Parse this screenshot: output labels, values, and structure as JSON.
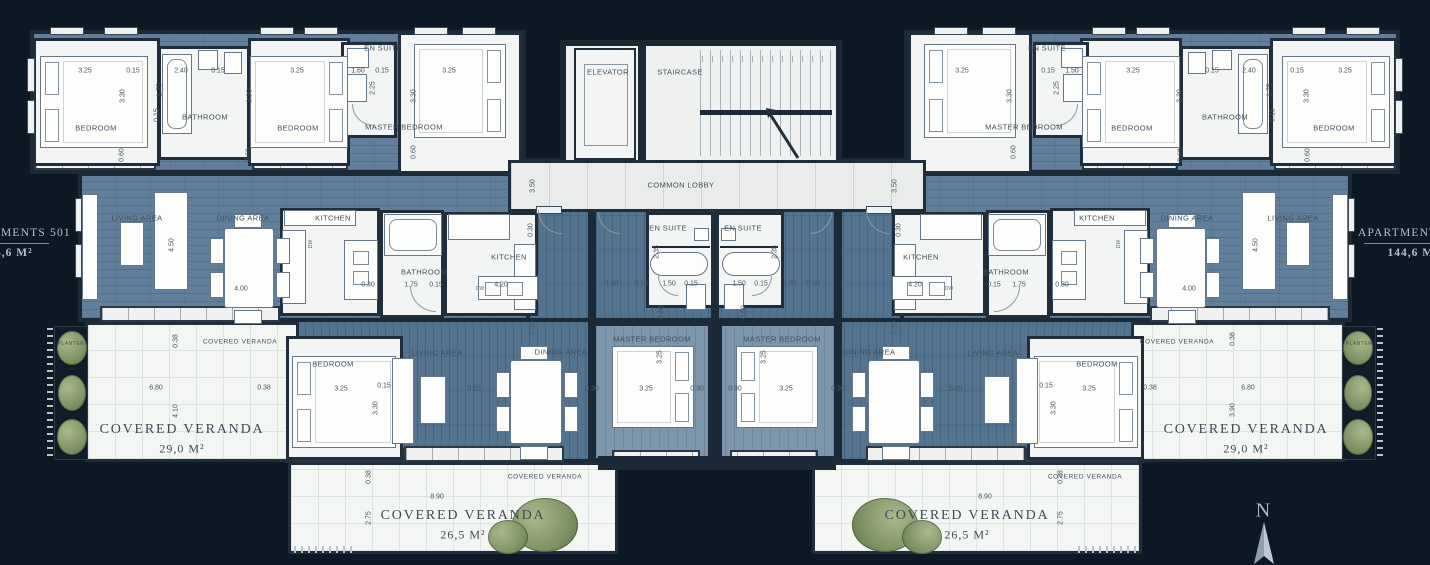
{
  "plan": {
    "background": "#0c1823",
    "floor_blue": "#617f9b",
    "floor_blue_dark": "#53738f",
    "room_white": "#f3f5f4",
    "wall_color": "#1c2a37",
    "label_color": "#3d4b57",
    "edge_text_color": "#b3c1cb",
    "plant_green": "#84966a"
  },
  "side_labels": {
    "left": {
      "name": "APARTMENTS 501",
      "area": "144,6 M²"
    },
    "right": {
      "name": "APARTMENTS 501",
      "area": "144,6 M²"
    }
  },
  "compass": {
    "label": "N"
  },
  "annotations": [
    {
      "t": "3.25",
      "x": 85,
      "y": 71,
      "c": "dim"
    },
    {
      "t": "0.15",
      "x": 133,
      "y": 71,
      "c": "dim"
    },
    {
      "t": "2.40",
      "x": 181,
      "y": 71,
      "c": "dim"
    },
    {
      "t": "0.15",
      "x": 218,
      "y": 71,
      "c": "dim"
    },
    {
      "t": "3.25",
      "x": 297,
      "y": 71,
      "c": "dim"
    },
    {
      "t": "1.60",
      "x": 358,
      "y": 71,
      "c": "dim"
    },
    {
      "t": "0.15",
      "x": 382,
      "y": 71,
      "c": "dim"
    },
    {
      "t": "3.25",
      "x": 449,
      "y": 71,
      "c": "dim"
    },
    {
      "t": "1.75",
      "x": 160,
      "y": 90,
      "c": "dim",
      "r": -90
    },
    {
      "t": "3.30",
      "x": 123,
      "y": 96,
      "c": "dim",
      "r": -90
    },
    {
      "t": "3.30",
      "x": 250,
      "y": 96,
      "c": "dim",
      "r": -90
    },
    {
      "t": "2.25",
      "x": 373,
      "y": 88,
      "c": "dim",
      "r": -90
    },
    {
      "t": "3.30",
      "x": 414,
      "y": 96,
      "c": "dim",
      "r": -90
    },
    {
      "t": "0.15",
      "x": 157,
      "y": 115,
      "c": "dim",
      "r": -90
    },
    {
      "t": "0.60",
      "x": 122,
      "y": 155,
      "c": "dim",
      "r": -90
    },
    {
      "t": "0.60",
      "x": 249,
      "y": 155,
      "c": "dim",
      "r": -90
    },
    {
      "t": "0.60",
      "x": 414,
      "y": 152,
      "c": "dim",
      "r": -90
    },
    {
      "t": "BEDROOM",
      "x": 96,
      "y": 128,
      "c": "room"
    },
    {
      "t": "BATHROOM",
      "x": 205,
      "y": 117,
      "c": "room"
    },
    {
      "t": "BEDROOM",
      "x": 298,
      "y": 128,
      "c": "room"
    },
    {
      "t": "EN SUITE",
      "x": 383,
      "y": 48,
      "c": "room"
    },
    {
      "t": "MASTER BEDROOM",
      "x": 404,
      "y": 127,
      "c": "room"
    },
    {
      "t": "3.25",
      "x": 1345,
      "y": 71,
      "c": "dim"
    },
    {
      "t": "0.15",
      "x": 1297,
      "y": 71,
      "c": "dim"
    },
    {
      "t": "2.40",
      "x": 1249,
      "y": 71,
      "c": "dim"
    },
    {
      "t": "0.15",
      "x": 1212,
      "y": 71,
      "c": "dim"
    },
    {
      "t": "3.25",
      "x": 1133,
      "y": 71,
      "c": "dim"
    },
    {
      "t": "1.50",
      "x": 1072,
      "y": 71,
      "c": "dim"
    },
    {
      "t": "0.15",
      "x": 1048,
      "y": 71,
      "c": "dim"
    },
    {
      "t": "3.25",
      "x": 962,
      "y": 71,
      "c": "dim"
    },
    {
      "t": "1.75",
      "x": 1270,
      "y": 90,
      "c": "dim",
      "r": -90
    },
    {
      "t": "3.30",
      "x": 1307,
      "y": 96,
      "c": "dim",
      "r": -90
    },
    {
      "t": "3.30",
      "x": 1180,
      "y": 96,
      "c": "dim",
      "r": -90
    },
    {
      "t": "2.25",
      "x": 1057,
      "y": 88,
      "c": "dim",
      "r": -90
    },
    {
      "t": "3.30",
      "x": 1010,
      "y": 96,
      "c": "dim",
      "r": -90
    },
    {
      "t": "0.15",
      "x": 1273,
      "y": 115,
      "c": "dim",
      "r": -90
    },
    {
      "t": "0.60",
      "x": 1308,
      "y": 155,
      "c": "dim",
      "r": -90
    },
    {
      "t": "0.60",
      "x": 1181,
      "y": 155,
      "c": "dim",
      "r": -90
    },
    {
      "t": "0.60",
      "x": 1014,
      "y": 152,
      "c": "dim",
      "r": -90
    },
    {
      "t": "BEDROOM",
      "x": 1334,
      "y": 128,
      "c": "room"
    },
    {
      "t": "BATHROOM",
      "x": 1225,
      "y": 117,
      "c": "room"
    },
    {
      "t": "BEDROOM",
      "x": 1132,
      "y": 128,
      "c": "room"
    },
    {
      "t": "EN SUITE",
      "x": 1047,
      "y": 48,
      "c": "room"
    },
    {
      "t": "MASTER BEDROOM",
      "x": 1024,
      "y": 127,
      "c": "room"
    },
    {
      "t": "ELEVATOR",
      "x": 608,
      "y": 72,
      "c": "room"
    },
    {
      "t": "STAIRCASE",
      "x": 680,
      "y": 72,
      "c": "room"
    },
    {
      "t": "COMMON LOBBY",
      "x": 681,
      "y": 185,
      "c": "room"
    },
    {
      "t": "3.50",
      "x": 533,
      "y": 186,
      "c": "dim",
      "r": -90
    },
    {
      "t": "3.50",
      "x": 895,
      "y": 186,
      "c": "dim",
      "r": -90
    },
    {
      "t": "EN SUITE",
      "x": 668,
      "y": 228,
      "c": "room"
    },
    {
      "t": "EN SUITE",
      "x": 743,
      "y": 228,
      "c": "room"
    },
    {
      "t": "2.35",
      "x": 657,
      "y": 252,
      "c": "dim",
      "r": -90
    },
    {
      "t": "2.35",
      "x": 775,
      "y": 252,
      "c": "dim",
      "r": -90
    },
    {
      "t": "1.60",
      "x": 612,
      "y": 284,
      "c": "dim"
    },
    {
      "t": "0.15",
      "x": 641,
      "y": 284,
      "c": "dim"
    },
    {
      "t": "1.50",
      "x": 669,
      "y": 284,
      "c": "dim"
    },
    {
      "t": "0.15",
      "x": 691,
      "y": 284,
      "c": "dim"
    },
    {
      "t": "1.50",
      "x": 739,
      "y": 284,
      "c": "dim"
    },
    {
      "t": "0.15",
      "x": 761,
      "y": 284,
      "c": "dim"
    },
    {
      "t": "1.80",
      "x": 790,
      "y": 284,
      "c": "dim"
    },
    {
      "t": "0.30",
      "x": 813,
      "y": 284,
      "c": "dim"
    },
    {
      "t": "0.60",
      "x": 662,
      "y": 312,
      "c": "dim",
      "r": -90
    },
    {
      "t": "0.60",
      "x": 744,
      "y": 312,
      "c": "dim",
      "r": -90
    },
    {
      "t": "7.20",
      "x": 533,
      "y": 328,
      "c": "dim",
      "r": -90
    },
    {
      "t": "7.20",
      "x": 895,
      "y": 328,
      "c": "dim",
      "r": -90
    },
    {
      "t": "MASTER BEDROOM",
      "x": 652,
      "y": 339,
      "c": "room"
    },
    {
      "t": "MASTER BEDROOM",
      "x": 782,
      "y": 339,
      "c": "room"
    },
    {
      "t": "3.25",
      "x": 660,
      "y": 357,
      "c": "dim",
      "r": -90
    },
    {
      "t": "3.25",
      "x": 764,
      "y": 357,
      "c": "dim",
      "r": -90
    },
    {
      "t": "3.25",
      "x": 646,
      "y": 389,
      "c": "dim"
    },
    {
      "t": "3.25",
      "x": 786,
      "y": 389,
      "c": "dim"
    },
    {
      "t": "0.30",
      "x": 697,
      "y": 389,
      "c": "dim"
    },
    {
      "t": "0.30",
      "x": 735,
      "y": 389,
      "c": "dim"
    },
    {
      "t": "LIVING AREA",
      "x": 137,
      "y": 218,
      "c": "room"
    },
    {
      "t": "DINING AREA",
      "x": 243,
      "y": 218,
      "c": "room"
    },
    {
      "t": "4.50",
      "x": 172,
      "y": 245,
      "c": "dim",
      "r": -90
    },
    {
      "t": "4.00",
      "x": 241,
      "y": 289,
      "c": "dim"
    },
    {
      "t": "KITCHEN",
      "x": 333,
      "y": 218,
      "c": "room"
    },
    {
      "t": "DW",
      "x": 311,
      "y": 244,
      "c": "tiny",
      "r": -90
    },
    {
      "t": "0.30",
      "x": 368,
      "y": 285,
      "c": "dim"
    },
    {
      "t": "1.75",
      "x": 411,
      "y": 285,
      "c": "dim"
    },
    {
      "t": "0.15",
      "x": 436,
      "y": 285,
      "c": "dim"
    },
    {
      "t": "BATHROOM",
      "x": 424,
      "y": 272,
      "c": "room"
    },
    {
      "t": "KITCHEN",
      "x": 509,
      "y": 257,
      "c": "room"
    },
    {
      "t": "4.20",
      "x": 501,
      "y": 285,
      "c": "dim"
    },
    {
      "t": "DW",
      "x": 480,
      "y": 289,
      "c": "tiny"
    },
    {
      "t": "0.30",
      "x": 531,
      "y": 230,
      "c": "dim",
      "r": -90
    },
    {
      "t": "LIVING AREA",
      "x": 1293,
      "y": 218,
      "c": "room"
    },
    {
      "t": "DINING AREA",
      "x": 1187,
      "y": 218,
      "c": "room"
    },
    {
      "t": "4.50",
      "x": 1256,
      "y": 245,
      "c": "dim",
      "r": -90
    },
    {
      "t": "4.00",
      "x": 1189,
      "y": 289,
      "c": "dim"
    },
    {
      "t": "KITCHEN",
      "x": 1097,
      "y": 218,
      "c": "room"
    },
    {
      "t": "DW",
      "x": 1119,
      "y": 244,
      "c": "tiny",
      "r": -90
    },
    {
      "t": "0.30",
      "x": 1062,
      "y": 285,
      "c": "dim"
    },
    {
      "t": "1.75",
      "x": 1019,
      "y": 285,
      "c": "dim"
    },
    {
      "t": "0.15",
      "x": 994,
      "y": 285,
      "c": "dim"
    },
    {
      "t": "BATHROOM",
      "x": 1006,
      "y": 272,
      "c": "room"
    },
    {
      "t": "KITCHEN",
      "x": 921,
      "y": 257,
      "c": "room"
    },
    {
      "t": "4.20",
      "x": 915,
      "y": 285,
      "c": "dim"
    },
    {
      "t": "DW",
      "x": 949,
      "y": 289,
      "c": "tiny"
    },
    {
      "t": "0.30",
      "x": 899,
      "y": 230,
      "c": "dim",
      "r": -90
    },
    {
      "t": "BEDROOM",
      "x": 333,
      "y": 364,
      "c": "room"
    },
    {
      "t": "3.25",
      "x": 341,
      "y": 389,
      "c": "dim"
    },
    {
      "t": "0.15",
      "x": 384,
      "y": 386,
      "c": "dim"
    },
    {
      "t": "3.30",
      "x": 376,
      "y": 408,
      "c": "dim",
      "r": -90
    },
    {
      "t": "LIVING AREA",
      "x": 437,
      "y": 353,
      "c": "room"
    },
    {
      "t": "5.85",
      "x": 474,
      "y": 389,
      "c": "dim"
    },
    {
      "t": "DINING AREA",
      "x": 561,
      "y": 352,
      "c": "room"
    },
    {
      "t": "0.30",
      "x": 592,
      "y": 389,
      "c": "dim"
    },
    {
      "t": "COVERED VERANDA",
      "x": 545,
      "y": 477,
      "c": "roomsm"
    },
    {
      "t": "0.38",
      "x": 369,
      "y": 477,
      "c": "dim",
      "r": -90
    },
    {
      "t": "8.90",
      "x": 437,
      "y": 497,
      "c": "dim"
    },
    {
      "t": "2.75",
      "x": 369,
      "y": 518,
      "c": "dim",
      "r": -90
    },
    {
      "t": "COVERED VERANDA",
      "x": 463,
      "y": 516,
      "c": "big"
    },
    {
      "t": "26,5 M²",
      "x": 463,
      "y": 535,
      "c": "area"
    },
    {
      "t": "BEDROOM",
      "x": 1097,
      "y": 364,
      "c": "room"
    },
    {
      "t": "3.25",
      "x": 1089,
      "y": 389,
      "c": "dim"
    },
    {
      "t": "0.15",
      "x": 1046,
      "y": 386,
      "c": "dim"
    },
    {
      "t": "3.30",
      "x": 1054,
      "y": 408,
      "c": "dim",
      "r": -90
    },
    {
      "t": "LIVING AREA",
      "x": 993,
      "y": 353,
      "c": "room"
    },
    {
      "t": "5.85",
      "x": 956,
      "y": 389,
      "c": "dim"
    },
    {
      "t": "DINING AREA",
      "x": 869,
      "y": 352,
      "c": "room"
    },
    {
      "t": "0.30",
      "x": 838,
      "y": 389,
      "c": "dim"
    },
    {
      "t": "COVERED VERANDA",
      "x": 1085,
      "y": 477,
      "c": "roomsm"
    },
    {
      "t": "0.38",
      "x": 1061,
      "y": 477,
      "c": "dim",
      "r": -90
    },
    {
      "t": "8.90",
      "x": 985,
      "y": 497,
      "c": "dim"
    },
    {
      "t": "2.75",
      "x": 1061,
      "y": 518,
      "c": "dim",
      "r": -90
    },
    {
      "t": "COVERED VERANDA",
      "x": 967,
      "y": 516,
      "c": "big"
    },
    {
      "t": "26,5 M²",
      "x": 967,
      "y": 535,
      "c": "area"
    },
    {
      "t": "COVERED VERANDA",
      "x": 240,
      "y": 342,
      "c": "roomsm"
    },
    {
      "t": "0.38",
      "x": 176,
      "y": 341,
      "c": "dim",
      "r": -90
    },
    {
      "t": "6.80",
      "x": 156,
      "y": 388,
      "c": "dim"
    },
    {
      "t": "0.38",
      "x": 264,
      "y": 388,
      "c": "dim"
    },
    {
      "t": "4.10",
      "x": 176,
      "y": 411,
      "c": "dim",
      "r": -90
    },
    {
      "t": "COVERED VERANDA",
      "x": 182,
      "y": 430,
      "c": "big"
    },
    {
      "t": "29,0 M²",
      "x": 182,
      "y": 449,
      "c": "area"
    },
    {
      "t": "PLANTER",
      "x": 71,
      "y": 344,
      "c": "planter"
    },
    {
      "t": "COVERED VERANDA",
      "x": 1177,
      "y": 342,
      "c": "roomsm"
    },
    {
      "t": "0.38",
      "x": 1233,
      "y": 339,
      "c": "dim",
      "r": -90
    },
    {
      "t": "0.38",
      "x": 1150,
      "y": 388,
      "c": "dim"
    },
    {
      "t": "6.80",
      "x": 1248,
      "y": 388,
      "c": "dim"
    },
    {
      "t": "3.90",
      "x": 1233,
      "y": 410,
      "c": "dim",
      "r": -90
    },
    {
      "t": "COVERED VERANDA",
      "x": 1246,
      "y": 430,
      "c": "big"
    },
    {
      "t": "29,0 M²",
      "x": 1246,
      "y": 449,
      "c": "area"
    },
    {
      "t": "PLANTER",
      "x": 1359,
      "y": 344,
      "c": "planter"
    }
  ]
}
